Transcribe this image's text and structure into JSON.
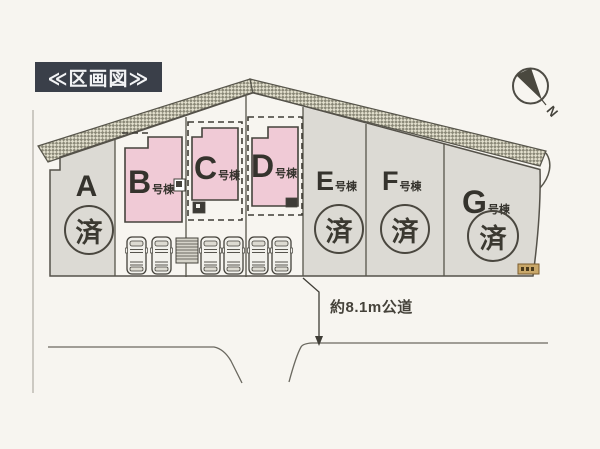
{
  "page": {
    "title": "≪区画図≫"
  },
  "compass": {
    "north_label": "N"
  },
  "road": {
    "label": "約8.1m公道"
  },
  "plots": {
    "a": {
      "letter": "A",
      "suffix": "",
      "status": "済"
    },
    "b": {
      "letter": "B",
      "suffix": "号棟"
    },
    "c": {
      "letter": "C",
      "suffix": "号棟"
    },
    "d": {
      "letter": "D",
      "suffix": "号棟"
    },
    "e": {
      "letter": "E",
      "suffix": "号棟",
      "status": "済"
    },
    "f": {
      "letter": "F",
      "suffix": "号棟",
      "status": "済"
    },
    "g": {
      "letter": "G",
      "suffix": "号棟",
      "status": "済"
    }
  },
  "colors": {
    "title_bg": "#3a3f49",
    "building_fill": "#f0cad6",
    "lot_fill": "#dcdad4",
    "sold_badge": "#4a473f"
  }
}
